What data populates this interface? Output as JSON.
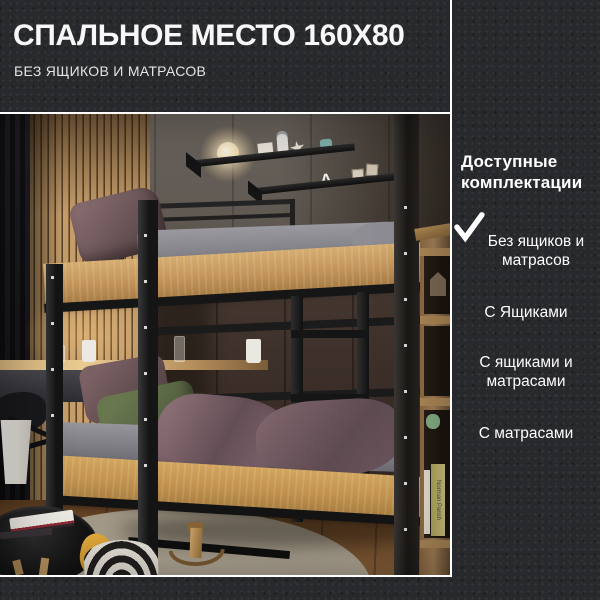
{
  "header": {
    "title": "СПАЛЬНОЕ МЕСТО 160Х80",
    "subtitle": "БЕЗ ЯЩИКОВ И МАТРАСОВ"
  },
  "options_panel": {
    "heading": "Доступные комплектации",
    "options": [
      {
        "label": "Без ящиков и матрасов",
        "selected": true
      },
      {
        "label": "С Ящиками",
        "selected": false
      },
      {
        "label": "С ящиками и матрасами",
        "selected": false
      },
      {
        "label": "С матрасами",
        "selected": false
      }
    ]
  },
  "photo": {
    "shelf_letter": "А",
    "book_spine_text": "Norman Parish"
  },
  "colors": {
    "background": "#28292c",
    "text": "#ffffff",
    "divider": "#ffffff",
    "oak_panel": "#c3945a",
    "metal_frame": "#1b1b1b"
  }
}
